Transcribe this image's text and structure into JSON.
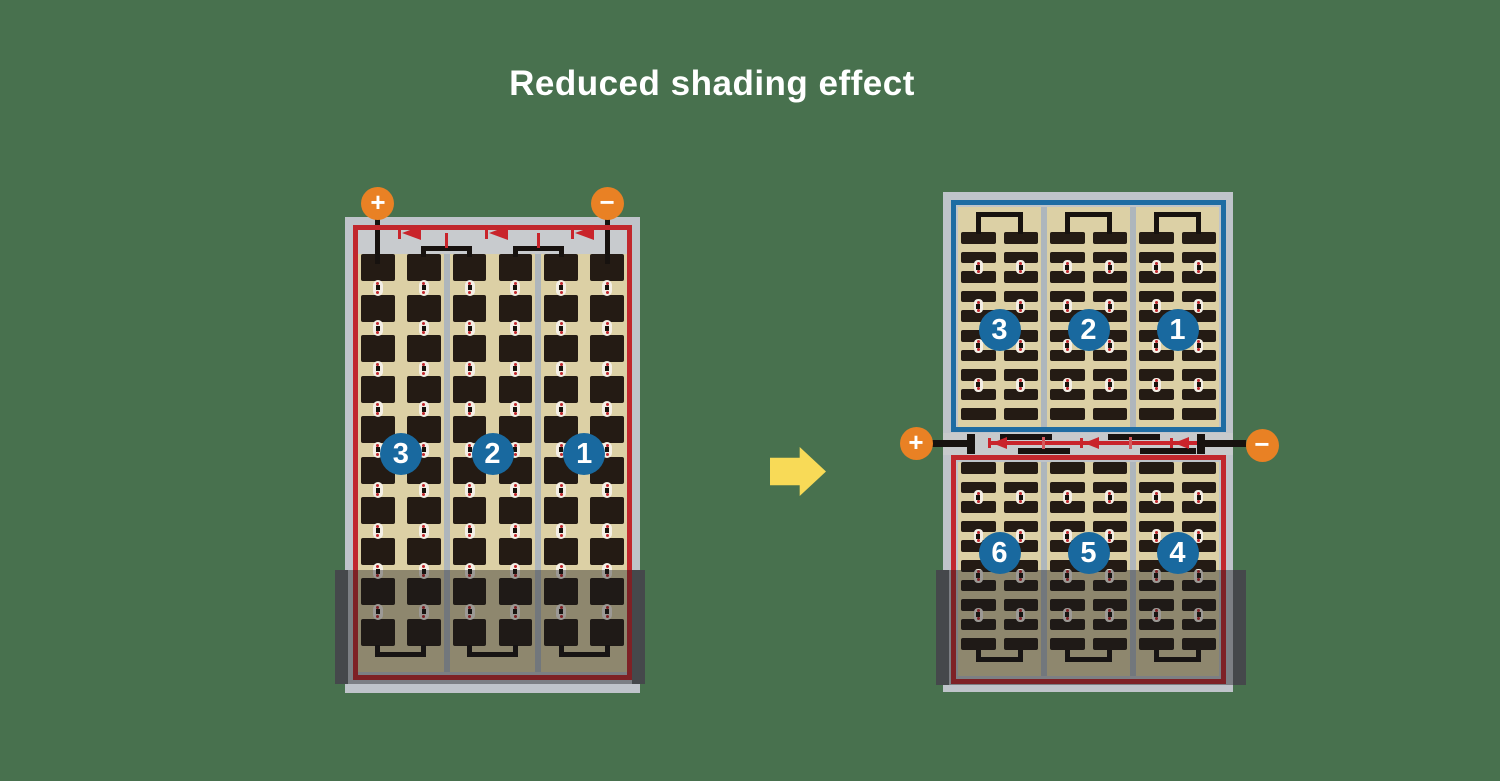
{
  "title": {
    "text": "Reduced shading effect"
  },
  "colors": {
    "background": "#48714E",
    "frame": "#BFC4CA",
    "strip": "#C8CBCE",
    "band": "#C7CACC",
    "tan": "#DCD0A5",
    "cell": "#241B14",
    "divider": "#AEB6BC",
    "wire": "#17120F",
    "red": "#C1272D",
    "diode_red": "#C9242B",
    "stub_red": "#D4595C",
    "blue": "#1E6CA3",
    "badge": "#19699F",
    "orange": "#E98124",
    "arrow": "#F8DA57",
    "shade": "rgba(24,25,27,0.40)",
    "shade_cap": "#45484B",
    "text": "#FFFFFF"
  },
  "left_panel": {
    "terminals": {
      "plus": "+",
      "minus": "−"
    },
    "substrings": [
      "3",
      "2",
      "1"
    ],
    "bypass_diodes": 3,
    "columns": 3,
    "subcolumns_per_column": 2,
    "rows": 10,
    "shaded_rows": 2
  },
  "arrow": {
    "direction": "right"
  },
  "right_panel": {
    "terminals": {
      "plus": "+",
      "minus": "−"
    },
    "substrings_top": [
      "3",
      "2",
      "1"
    ],
    "substrings_bottom": [
      "6",
      "5",
      "4"
    ],
    "bypass_diodes": 3,
    "columns": 3,
    "subcolumns_per_column": 2,
    "rows_per_half": 10,
    "shaded": true
  }
}
